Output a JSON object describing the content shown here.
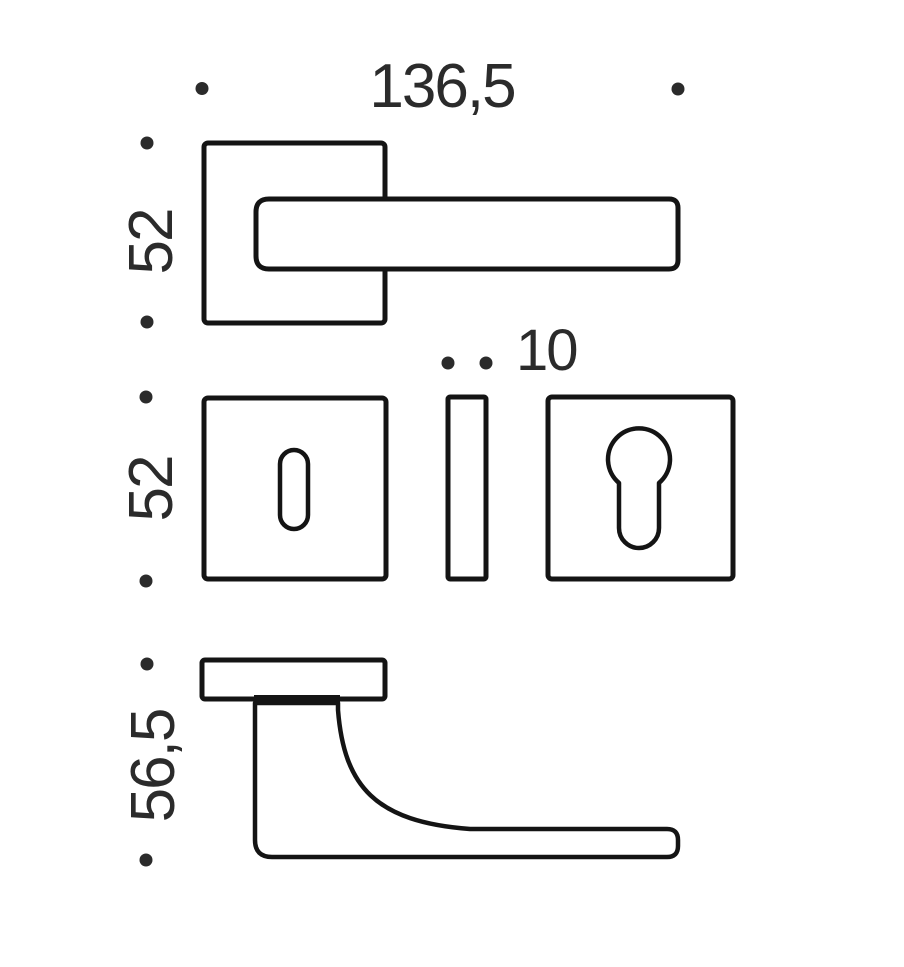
{
  "colors": {
    "line": "#141414",
    "text": "#2b2b2b",
    "dot": "#2b2b2b",
    "background": "#ffffff"
  },
  "dimensions": {
    "top_view": {
      "width": "136,5",
      "height": "52"
    },
    "escutcheon_row": {
      "height": "52",
      "thickness": "10"
    },
    "side_view": {
      "height": "56,5"
    }
  }
}
